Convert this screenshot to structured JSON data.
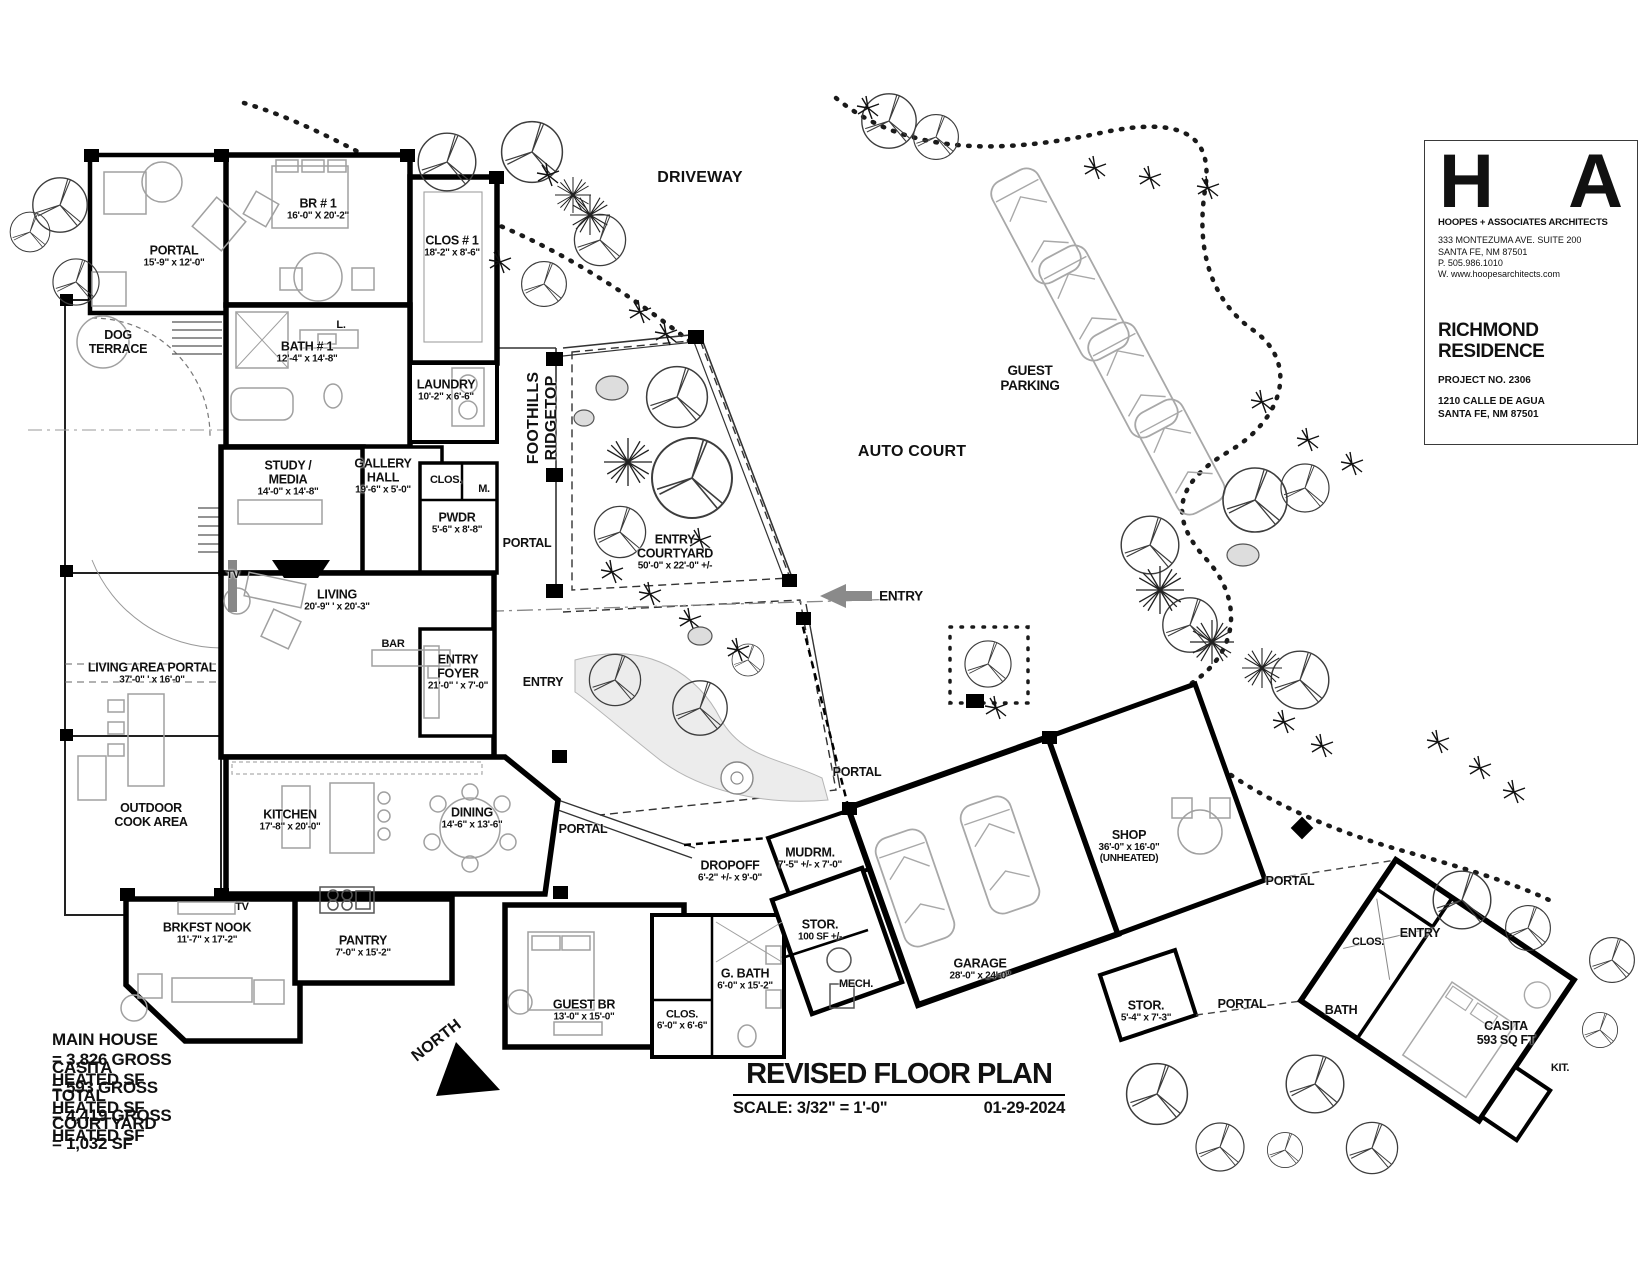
{
  "site": {
    "driveway": "DRIVEWAY",
    "guest_parking_1": "GUEST",
    "guest_parking_2": "PARKING",
    "auto_court": "AUTO COURT",
    "entry": "ENTRY",
    "foothills_1": "FOOTHILLS",
    "foothills_2": "RIDGETOP",
    "north": "NORTH"
  },
  "rooms": {
    "portal_nw": {
      "n": "PORTAL",
      "d": "15'-9\" x 12'-0\""
    },
    "br1": {
      "n": "BR # 1",
      "d": "16'-0\" X 20'-2\""
    },
    "clos1": {
      "n": "CLOS # 1",
      "d": "18'-2\" x 8'-6\""
    },
    "dog_terrace": {
      "n1": "DOG",
      "n2": "TERRACE"
    },
    "bath1": {
      "n": "BATH # 1",
      "d": "12'-4\" x 14'-8\""
    },
    "linen": {
      "n": "L."
    },
    "laundry": {
      "n": "LAUNDRY",
      "d": "10'-2\" x 6'-6\""
    },
    "study": {
      "n1": "STUDY /",
      "n2": "MEDIA",
      "d": "14'-0\" x 14'-8\""
    },
    "gallery": {
      "n1": "GALLERY",
      "n2": "HALL",
      "d": "19'-6\" x 5'-0\""
    },
    "clos_hall": {
      "n": "CLOS."
    },
    "m_clos": {
      "n": "M."
    },
    "pwdr": {
      "n": "PWDR",
      "d": "5'-6\" x 8'-8\""
    },
    "portal_east": {
      "n": "PORTAL"
    },
    "tv_living": {
      "n": "TV"
    },
    "living": {
      "n": "LIVING",
      "d": "20'-9\" ' x 20'-3\""
    },
    "bar": {
      "n": "BAR"
    },
    "entry_foyer": {
      "n1": "ENTRY",
      "n2": "FOYER",
      "d": "21'-0\" ' x 7'-0\""
    },
    "entry_inner": {
      "n": "ENTRY"
    },
    "entry_courtyard": {
      "n1": "ENTRY",
      "n2": "COURTYARD",
      "d": "50'-0\" x 22'-0\" +/-"
    },
    "living_area_portal": {
      "n": "LIVING AREA PORTAL",
      "d": "37'-0\" ' x 16'-0\""
    },
    "outdoor_cook": {
      "n1": "OUTDOOR",
      "n2": "COOK AREA"
    },
    "kitchen": {
      "n": "KITCHEN",
      "d": "17'-8\" x 20'-0\""
    },
    "dining": {
      "n": "DINING",
      "d": "14'-6\" x 13'-6\""
    },
    "portal_dining": {
      "n": "PORTAL"
    },
    "tv_nook": {
      "n": "TV"
    },
    "brkfst": {
      "n": "BRKFST NOOK",
      "d": "11'-7\" x 17'-2\""
    },
    "pantry": {
      "n": "PANTRY",
      "d": "7'-0\" x 15'-2\""
    },
    "guest_br": {
      "n": "GUEST BR",
      "d": "13'-0\" x 15'-0\""
    },
    "clos_guest": {
      "n": "CLOS.",
      "d": "6'-0\" x 6'-6\""
    },
    "gbath": {
      "n": "G. BATH",
      "d": "6'-0\" x 15'-2\""
    },
    "dropoff": {
      "n": "DROPOFF",
      "d": "6'-2\" +/- x 9'-0\""
    },
    "mudrm": {
      "n": "MUDRM.",
      "d": "7'-5\" +/- x 7'-0\""
    },
    "stor100": {
      "n": "STOR.",
      "d": "100 SF +/-"
    },
    "mech": {
      "n": "MECH."
    },
    "garage": {
      "n": "GARAGE",
      "d": "28'-0\" x 24'-0\""
    },
    "shop": {
      "n": "SHOP",
      "d": "36'-0\" x 16'-0\"",
      "d2": "(UNHEATED)"
    },
    "stor54": {
      "n": "STOR.",
      "d": "5'-4\" x 7'-3\""
    },
    "portal_garage": {
      "n": "PORTAL"
    },
    "portal_shop": {
      "n": "PORTAL"
    },
    "portal_casita": {
      "n": "PORTAL"
    },
    "clos_casita": {
      "n": "CLOS."
    },
    "entry_casita": {
      "n": "ENTRY"
    },
    "bath_casita": {
      "n": "BATH"
    },
    "casita": {
      "n": "CASITA",
      "d": "593 SQ FT"
    },
    "kit_casita": {
      "n": "KIT."
    }
  },
  "area_summary": {
    "rows": [
      {
        "label": "MAIN HOUSE",
        "value": "=  3,826 GROSS HEATED SF"
      },
      {
        "label": "CASITA",
        "value": "=  593 GROSS HEATED SF"
      },
      {
        "label": "TOTAL",
        "value": "=  4,419 GROSS HEATED SF"
      },
      {
        "label": "COURTYARD",
        "value": "=  1,032  SF"
      }
    ]
  },
  "plan_title": {
    "title": "REVISED FLOOR PLAN",
    "scale": "SCALE: 3/32\" = 1'-0\"",
    "date": "01-29-2024"
  },
  "title_block": {
    "logo_h": "H",
    "logo_a": "A",
    "firm": "HOOPES + ASSOCIATES ARCHITECTS",
    "address1": "333 MONTEZUMA AVE. SUITE 200",
    "address2": "SANTA FE, NM 87501",
    "phone": "P.  505.986.1010",
    "web": "W. www.hoopesarchitects.com",
    "project_name1": "RICHMOND",
    "project_name2": "RESIDENCE",
    "project_no": "PROJECT NO. 2306",
    "project_addr1": "1210 CALLE DE AGUA",
    "project_addr2": "SANTA FE, NM 87501"
  }
}
